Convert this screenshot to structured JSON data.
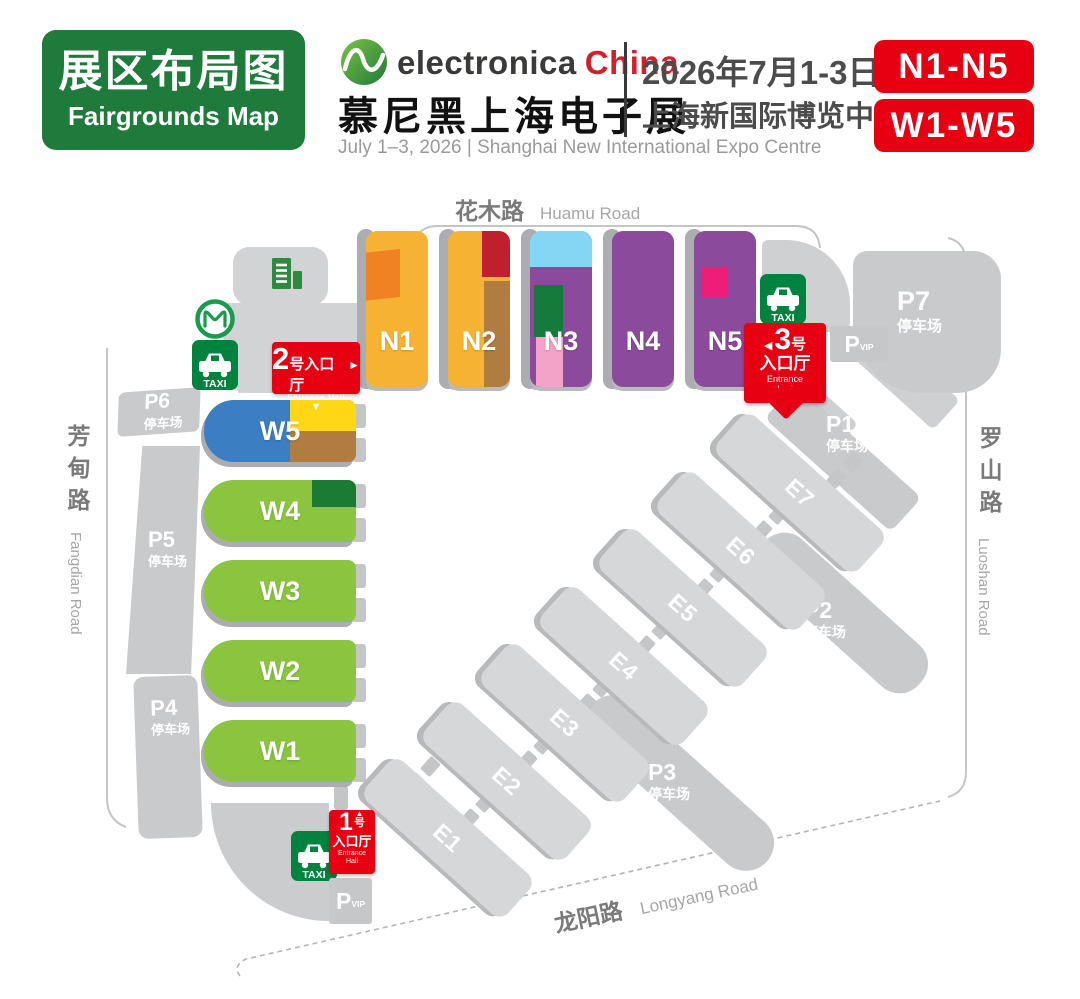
{
  "header": {
    "title_cn": "展区布局图",
    "title_en": "Fairgrounds Map",
    "brand": "electronica",
    "brand_country": "China",
    "expo_cn": "慕尼黑上海电子展",
    "date_cn": "2026年7月1-3日",
    "venue_cn": "上海新国际博览中心",
    "date_venue_en": "July 1–3, 2026 | Shanghai New International Expo Centre",
    "badge_n": "N1-N5",
    "badge_w": "W1-W5",
    "colors": {
      "green": "#1e7b3b",
      "red": "#e60012",
      "brand_red": "#d0202c"
    }
  },
  "map": {
    "palette": {
      "hall_yellow": "#f6b333",
      "orange": "#f08223",
      "dark_red": "#c0202e",
      "brown": "#b17c42",
      "purple": "#8c4a9c",
      "light_blue": "#85d6f4",
      "patch_green": "#157b3d",
      "pink": "#f2a3c6",
      "magenta": "#ee1d7a",
      "blue": "#3c7ec2",
      "bright_yellow": "#ffd714",
      "green": "#8bc53f",
      "dark_green": "#1b7a33",
      "sign_red": "#e60012",
      "taxi_green": "#00833e",
      "gray_block": "#c9cacc"
    },
    "roads": {
      "huamu_cn": "花木路",
      "huamu_en": "Huamu Road",
      "luoshan_cn": "罗山路",
      "luoshan_en": "Luoshan Road",
      "fangdian_cn": "芳甸路",
      "fangdian_en": "Fangdian Road",
      "longyang_cn": "龙阳路",
      "longyang_en": "Longyang Road"
    },
    "n_halls": [
      {
        "label": "N1"
      },
      {
        "label": "N2"
      },
      {
        "label": "N3"
      },
      {
        "label": "N4"
      },
      {
        "label": "N5"
      }
    ],
    "w_halls": [
      {
        "label": "W5"
      },
      {
        "label": "W4"
      },
      {
        "label": "W3"
      },
      {
        "label": "W2"
      },
      {
        "label": "W1"
      }
    ],
    "e_halls": [
      {
        "label": "E1"
      },
      {
        "label": "E2"
      },
      {
        "label": "E3"
      },
      {
        "label": "E4"
      },
      {
        "label": "E5"
      },
      {
        "label": "E6"
      },
      {
        "label": "E7"
      }
    ],
    "parking": {
      "p1": {
        "name": "P1",
        "sub": "停车场"
      },
      "p2": {
        "name": "P2",
        "sub": "停车场"
      },
      "p3": {
        "name": "P3",
        "sub": "停车场"
      },
      "p4": {
        "name": "P4",
        "sub": "停车场"
      },
      "p5": {
        "name": "P5",
        "sub": "停车场"
      },
      "p6": {
        "name": "P6",
        "sub": "停车场"
      },
      "p7": {
        "name": "P7",
        "sub": "停车场"
      }
    },
    "entrances": {
      "hall1": {
        "num": "1",
        "hao": "号",
        "lobby": "入口厅",
        "en_line1": "Entrance",
        "en_line2": "Hall"
      },
      "hall2": {
        "num": "2",
        "label": "号入口厅",
        "en": "Entrance Hall"
      },
      "hall3": {
        "num": "3",
        "hao": "号",
        "lobby": "入口厅",
        "en_line1": "Entrance",
        "en_line2": "Hall"
      }
    },
    "icons": {
      "taxi": "TAXI",
      "p": "P",
      "vip": "VIP",
      "arrow_up": "▲",
      "arrow_down": "▼",
      "arrow_right": "►",
      "arrow_left": "◀"
    }
  }
}
